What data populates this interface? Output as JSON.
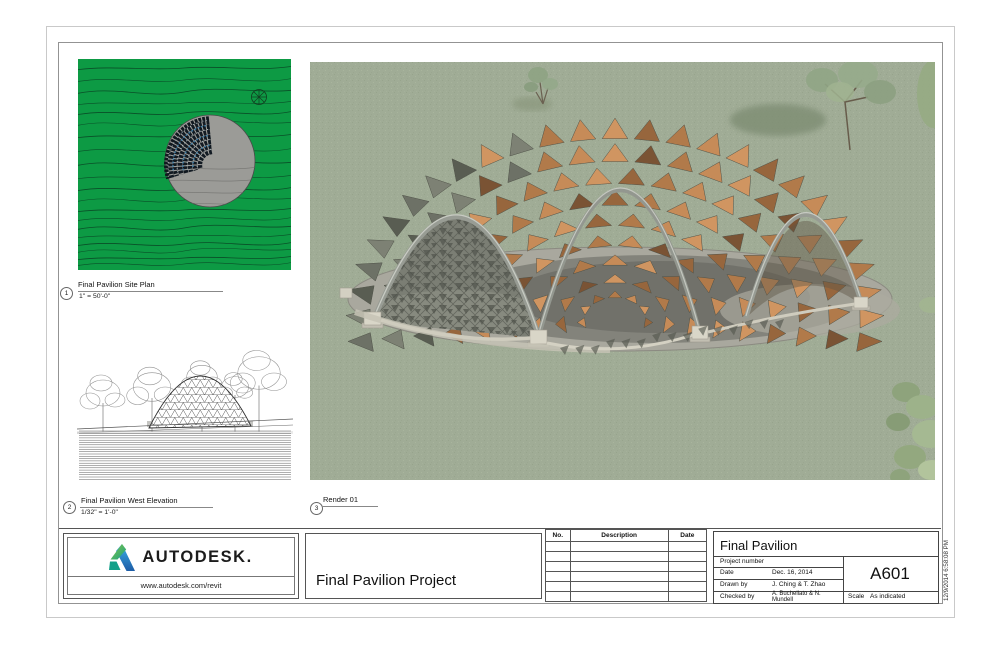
{
  "viewports": {
    "site_plan": {
      "number": "1",
      "title": "Final Pavilion Site Plan",
      "scale": "1\" = 50'-0\""
    },
    "west_elevation": {
      "number": "2",
      "title": "Final Pavilion West Elevation",
      "scale": "1/32\" = 1'-0\""
    },
    "render": {
      "number": "3",
      "title": "Render 01"
    }
  },
  "titleblock": {
    "brand": "AUTODESK.",
    "url": "www.autodesk.com/revit",
    "project_title": "Final Pavilion Project",
    "revision_headers": {
      "no": "No.",
      "description": "Description",
      "date": "Date"
    },
    "revision_rows": [
      "",
      "",
      "",
      "",
      "",
      ""
    ],
    "info": {
      "title": "Final Pavilion",
      "project_number_label": "Project number",
      "project_number_value": "",
      "date_label": "Date",
      "date_value": "Dec. 16, 2014",
      "drawn_by_label": "Drawn by",
      "drawn_by_value": "J. Ching & T. Zhao",
      "checked_by_label": "Checked by",
      "checked_by_value": "A. Buchellato & N. Mundell",
      "sheet_number": "A601",
      "scale_label": "Scale",
      "scale_value": "As indicated"
    },
    "print_timestamp": "12/9/2014 6:58:08 PM"
  },
  "colors": {
    "site_green": "#0d9a44",
    "contour": "#0a4f28",
    "grass": "#a0ac96",
    "pad": "#a9a89e",
    "steel": "#989c94",
    "wood_palette": [
      "#c68b58",
      "#b17a4a",
      "#97663d",
      "#d09561"
    ],
    "wood_dark": "#7a5334",
    "shadow_palette": [
      "#6d7166",
      "#7d8174",
      "#595d52"
    ],
    "logo_blue": "#1d5ca6",
    "logo_green": "#8cc63f",
    "logo_teal": "#12a089"
  },
  "icons": {
    "north_arrow": "north-arrow-icon",
    "autodesk_logo": "autodesk-logo-icon"
  }
}
